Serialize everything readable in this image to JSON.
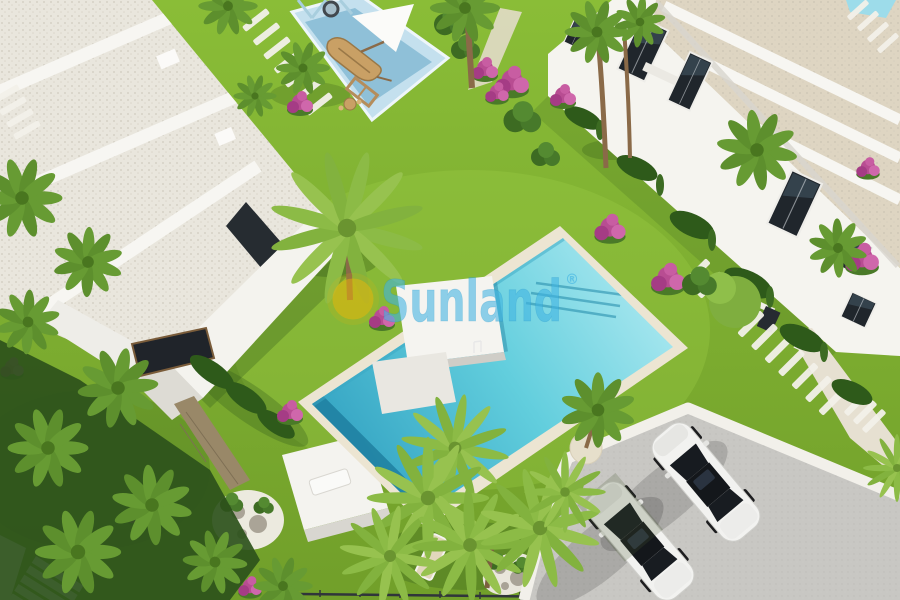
{
  "watermark": {
    "brand": "Sunland",
    "registered_mark": "®",
    "logo_icon": "sun-icon",
    "text_color": "#3fb3e2",
    "sun_color": "#f2b606"
  },
  "colors": {
    "grass": "#719f2a",
    "grass_light": "#8abd37",
    "grass_dark": "#33591a",
    "pool": "#62cedd",
    "pool_light": "#a8e7ef",
    "pool_deep": "#2f9fc0",
    "coping": "#ece5d2",
    "roof_gravel": "#e9e6dd",
    "roof_gravel_warm": "#ded5c2",
    "wall_white": "#f5f4ef",
    "wall_shade": "#d9d6cf",
    "glass_dark": "#20262c",
    "pavement": "#c8c7c3",
    "curb": "#f2f0ea",
    "car_white": "#f2f2f0",
    "playground_light": "#c4e0ee",
    "playground_mid": "#8fc0d8",
    "wood": "#c9a065",
    "flower_pink": "#bb4d95",
    "palm_green": "#679b33",
    "palm_light": "#8cbb46",
    "stone_wall": "#998868",
    "sand": "#e6dfcb",
    "wm_blue": "#3fb3e2",
    "wm_yellow": "#f2b606"
  },
  "scene_features": [
    "white-villa-gravel-roof",
    "townhouse-row",
    "main-swimming-pool",
    "kids-playground",
    "parking-lot",
    "white-sedan-car",
    "palm-tree",
    "bougainvillea-bush",
    "stepping-stone-path",
    "sun-deck",
    "rock-garden"
  ]
}
